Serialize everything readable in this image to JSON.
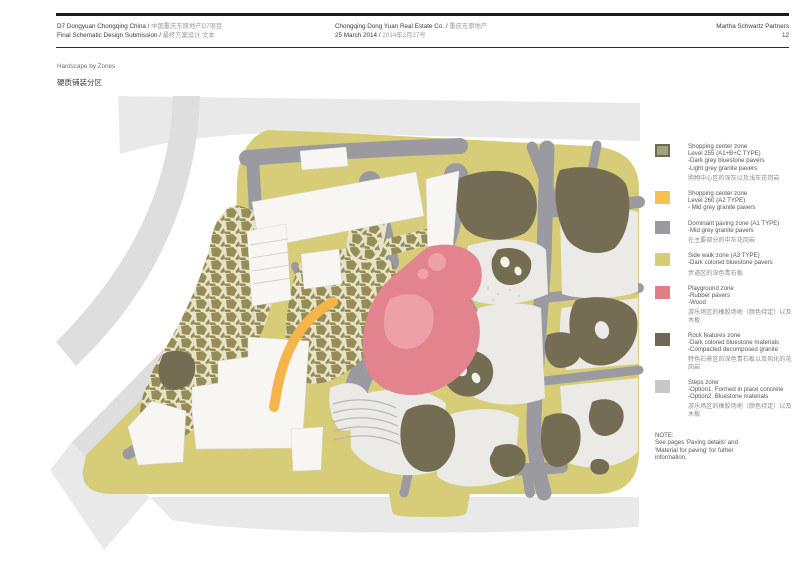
{
  "header": {
    "project_en": "D7 Dongyuan Chongqing China /",
    "project_cn": "中国重庆东原地产D7项目",
    "submission_en": "Final Schematic Design Submission /",
    "submission_cn": "最终方案设计 文本",
    "client_en": "Chongqing Dong Yuan Real Estate Co. /",
    "client_cn": "重庆东原地产",
    "date_en": "25 March 2014 /",
    "date_cn": "2014年2月27号",
    "firm": "Martha Schwartz Partners",
    "page_number": "12"
  },
  "subtitle": {
    "en": "Hardscape by Zones",
    "cn": "硬质铺装分区"
  },
  "legend": {
    "items": [
      {
        "color": "#a2a184",
        "border": "#6e6d48",
        "lines": [
          "Shopping center zone",
          "Level 255 (A1+B+C TYPE)",
          "-Dark grey bluestone pavers",
          "-Light grey granite pavers"
        ],
        "cn": "购物中心区的深灰以及浅灰花岗岩"
      },
      {
        "color": "#f6c052",
        "lines": [
          "Shopping center zone",
          "Level 260 (A2 TYPE)",
          "- Mid grey granite pavers"
        ],
        "cn": ""
      },
      {
        "color": "#9b9aa1",
        "lines": [
          "Dominant paving zone (A1 TYPE)",
          "-Mid grey granite pavers"
        ],
        "cn": "在主要部分的中灰花岗岩"
      },
      {
        "color": "#d7cd79",
        "lines": [
          "Side walk zone (A3 TYPE)",
          "-Dark colored bluestone pavers"
        ],
        "cn": "步道区的深色青石板"
      },
      {
        "color": "#e07f86",
        "lines": [
          "Playground zone",
          "-Rubber pavers",
          "-Wood"
        ],
        "cn": "游乐场区的橡胶场地（颜色待定）以及木板"
      },
      {
        "color": "#6e6656",
        "lines": [
          "Rock features zone",
          "-Dark colored bluestone materials",
          "-Compacted decomposed granite"
        ],
        "cn": "特色石景区的深色青石板以及风化的花岗岩"
      },
      {
        "color": "#c7c9c8",
        "lines": [
          "Steps zone",
          "-Option1. Formed in place concrete",
          "-Option2. Bluestone materials"
        ],
        "cn": "游乐场区的橡胶场地（颜色待定）以及木板"
      }
    ]
  },
  "note": {
    "lines": [
      "NOTE:",
      "See pages 'Paving details' and",
      "'Material for paving' for futher",
      "information."
    ]
  },
  "zones": {
    "site": "#d7cd79",
    "path": "#9b9aa1",
    "plaza": "#ebeae7",
    "building": "#f7f6f2",
    "rock": "#746c53",
    "mosaic_cell": "#968c55",
    "mosaic_gap": "#e7e3c8",
    "playground": "#e2838e",
    "playground_light": "#eda0a8",
    "accent_orange": "#f4b54b",
    "context": "#e9e9e9",
    "context_dark": "#dedede",
    "white_detail": "#f3f1ea",
    "speckle": "#c9c9c9",
    "terrace_line": "#b4b4ba"
  }
}
